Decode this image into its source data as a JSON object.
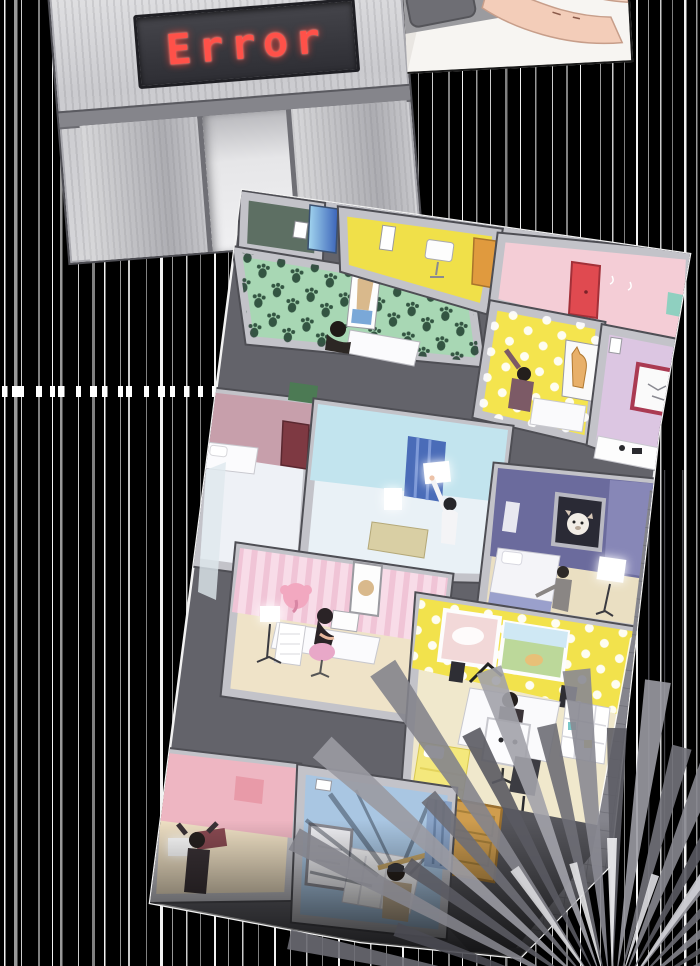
{
  "scene": {
    "elevator": {
      "display_text": "Error",
      "display_text_color": "#ff5149"
    },
    "palette": {
      "background": "#000000",
      "speed_line": "#ffffff",
      "wall_band": "#c3c3c9",
      "wall_edge": "#4e4e54",
      "panel_outline": "#f2f2f2",
      "panel_base": "#63636a"
    },
    "rooms": {
      "green_paw": {
        "wall": "#5d6f63",
        "floor": "#a8d7b4",
        "door": "#3a62b8"
      },
      "yellow_top": {
        "wall": "#f0e049",
        "door": "#e09a3e"
      },
      "pink_top": {
        "wall": "#f4cdd6",
        "door": "#e04a50"
      },
      "polka_cat": {
        "wall": "#f4e44e"
      },
      "lavender": {
        "wall": "#dcc6e2",
        "frame": "#aa3a52"
      },
      "mauve": {
        "wall": "#c79fab",
        "door": "#7e3942"
      },
      "cyan": {
        "wall": "#c2e4ee",
        "curtain": "#4a6cb8"
      },
      "purple": {
        "wall": "#6b6b9d"
      },
      "pink_striped": {
        "wall": "#f6d7e2",
        "floor": "#efe3c8"
      },
      "polka_studio": {
        "wall": "#f2e24c",
        "floor": "#f0e8cc",
        "bed": "#f4e87c",
        "door": "#cf9d4e"
      },
      "pink_bottom": {
        "wall": "#eeb6c2",
        "floor": "#efe0c4"
      },
      "blue_bottom": {
        "wall": "#a9c6e2",
        "curtain": "#8aa4c8"
      }
    }
  }
}
